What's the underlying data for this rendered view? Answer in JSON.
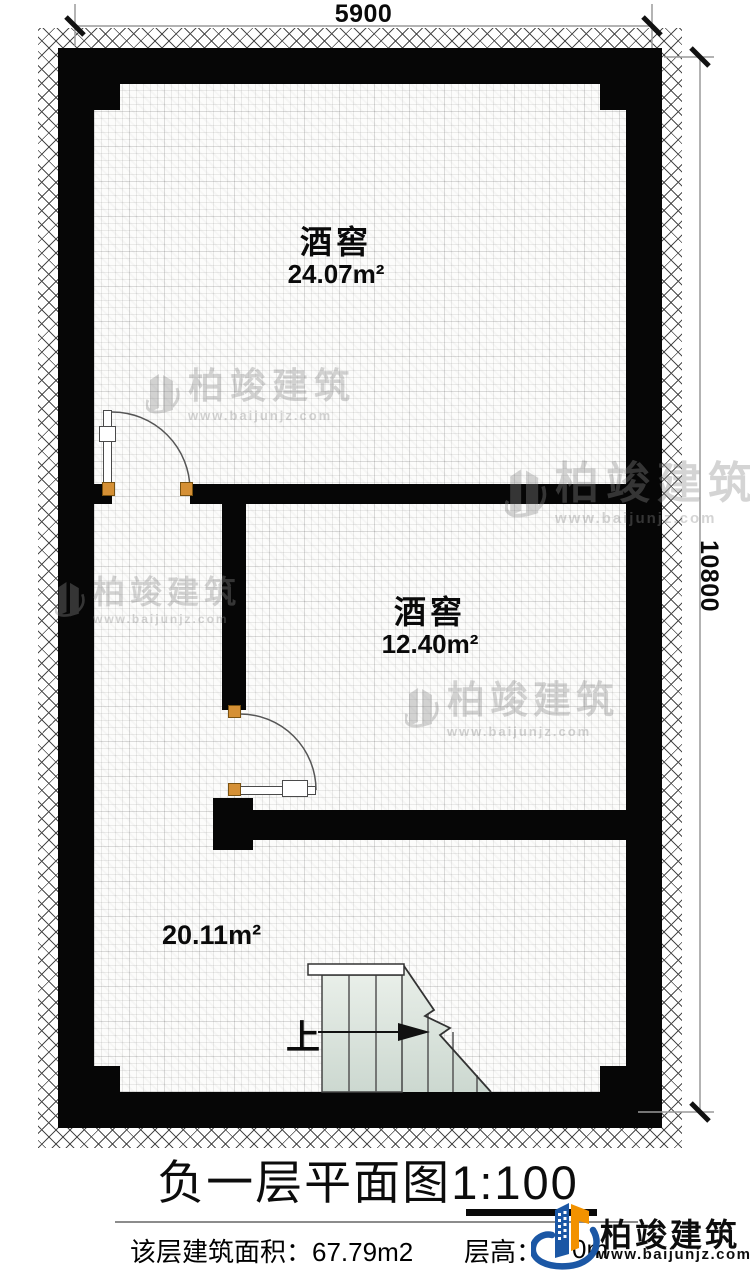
{
  "colors": {
    "wall": "#060606",
    "door_frame": "#d59035",
    "stair_fill": "#dfe7e1",
    "brand_blue": "#1b57a5",
    "brand_orange": "#f29200",
    "watermark_gray": "#8a8a8a"
  },
  "dimensions": {
    "top_width": "5900",
    "right_height": "10800"
  },
  "rooms": [
    {
      "name": "酒窖",
      "area": "24.07m²"
    },
    {
      "name": "酒窖",
      "area": "12.40m²"
    },
    {
      "area": "20.11m²"
    }
  ],
  "stairs": {
    "up_label": "上"
  },
  "title": {
    "name": "负一层平面图",
    "scale": "1:100"
  },
  "footer": {
    "area_label": "该层建筑面积：",
    "area_value": "67.79m2",
    "height_label": "层高：",
    "height_value_partial": "0m"
  },
  "brand": {
    "company": "柏竣建筑",
    "website": "www.baijunjz.com"
  },
  "watermark": {
    "company": "柏竣建筑",
    "website": "www.baijunjz.com"
  }
}
